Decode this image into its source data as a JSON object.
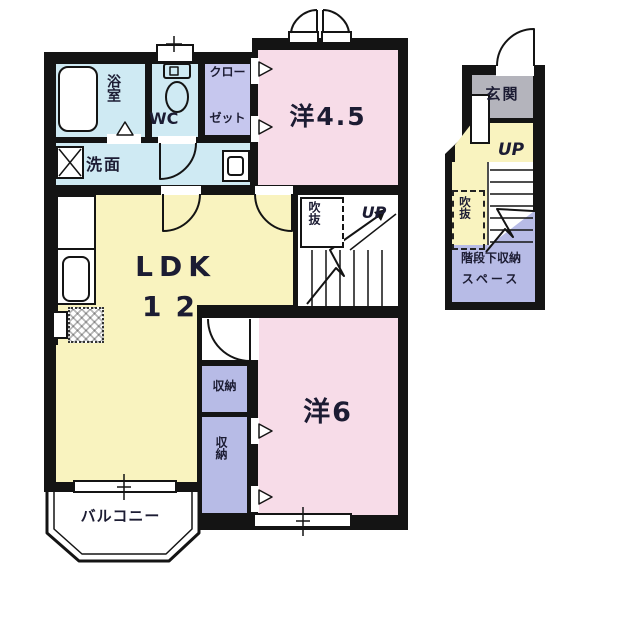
{
  "plans": {
    "main": {
      "rooms": [
        {
          "name": "bathroom",
          "label": "浴室"
        },
        {
          "name": "toilet",
          "label": "WC"
        },
        {
          "name": "closet",
          "label_line1": "クロー",
          "label_line2": "ゼット"
        },
        {
          "name": "western-room-4-5",
          "label": "洋4.5"
        },
        {
          "name": "washroom",
          "label": "洗面"
        },
        {
          "name": "ldk",
          "label_line1": "LDK",
          "label_line2": "12"
        },
        {
          "name": "void",
          "label": "吹抜"
        },
        {
          "name": "stairs-up",
          "label": "UP"
        },
        {
          "name": "storage-upper",
          "label": "収納"
        },
        {
          "name": "storage-lower",
          "label": "収納"
        },
        {
          "name": "western-room-6",
          "label": "洋6"
        },
        {
          "name": "balcony",
          "label": "バルコニー"
        }
      ]
    },
    "entry": {
      "rooms": [
        {
          "name": "entrance",
          "label": "玄関"
        },
        {
          "name": "stairs-up",
          "label": "UP"
        },
        {
          "name": "void",
          "label": "吹抜"
        },
        {
          "name": "under-stair-storage",
          "label_line1": "階段下収納",
          "label_line2": "スペース"
        }
      ]
    }
  },
  "colors": {
    "wall": "#141414",
    "room_pink": "#f7dce8",
    "room_yellow": "#f9f3bf",
    "room_blue": "#cfeaf3",
    "room_purple_light": "#c6c7ee",
    "room_purple": "#b7bbe6",
    "room_gray": "#b4b4bc",
    "background": "#ffffff",
    "text": "#1c1c33"
  }
}
